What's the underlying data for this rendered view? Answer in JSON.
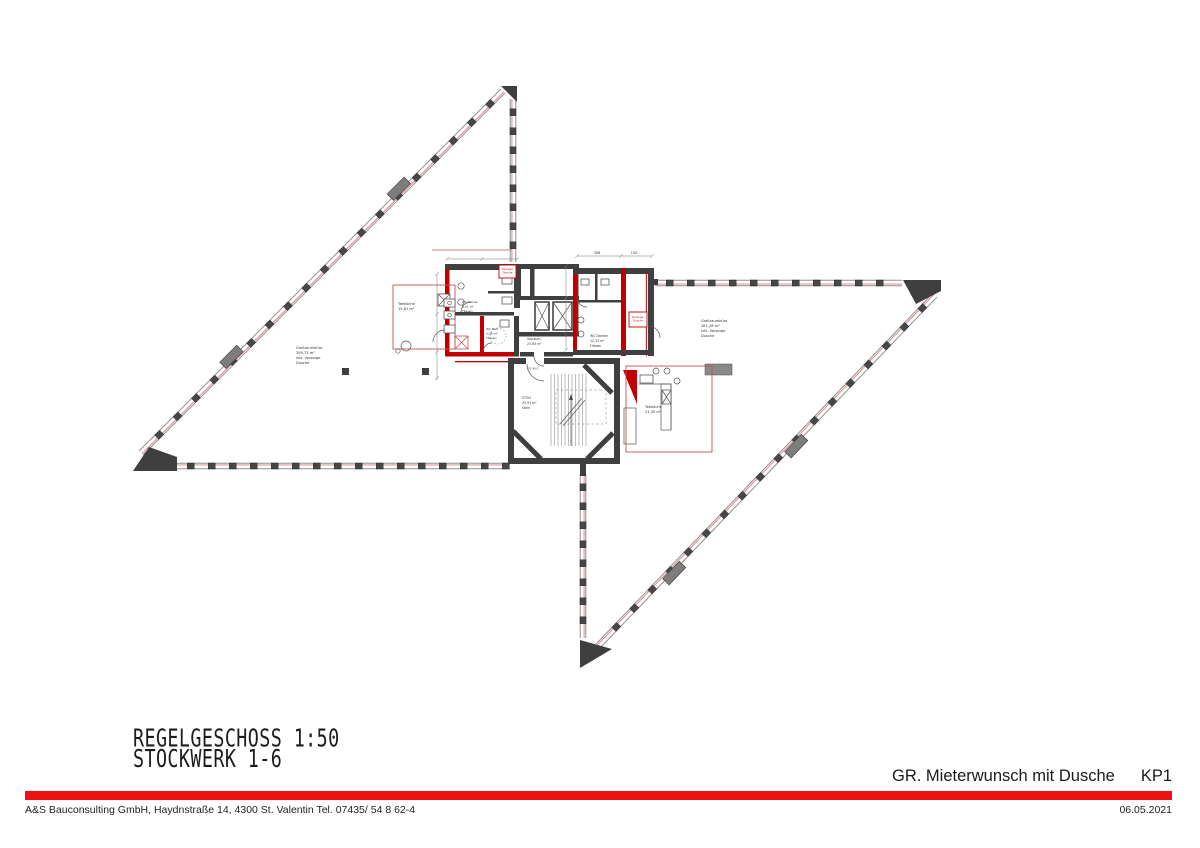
{
  "colors": {
    "accent_red": "#ee1111",
    "marking_red": "#c00000",
    "facade_line_red": "#d08080",
    "wall_gray": "#3f3f3f"
  },
  "titles": {
    "drawing_line1": "REGELGESCHOSS 1:50",
    "drawing_line2": "STOCKWERK 1-6",
    "variant_name": "GR. Mieterwunsch mit Dusche",
    "variant_code": "KP1"
  },
  "footer": {
    "company": "A&S Bauconsulting GmbH, Haydnstraße 14, 4300 St. Valentin Tel. 07435/ 54 8 62-4",
    "date": "06.05.2021"
  },
  "plan": {
    "rooms": {
      "office_left": {
        "name": "Großraumbüro",
        "area": "290,73 m²",
        "note1": "inkl. Vorsorge",
        "note2": "Dusche"
      },
      "office_right": {
        "name": "Großraumbüro",
        "area": "281,26 m²",
        "note1": "inkl. Vorsorge",
        "note2": "Dusche"
      },
      "tea_left": {
        "name": "Teeküche",
        "area": "15,81 m²"
      },
      "tea_right": {
        "name": "Teeküche",
        "area": "21,35 m²"
      },
      "wc_men": {
        "name": "WC Herren",
        "area": "9,61 m²",
        "finish": "Fliesen"
      },
      "wc_acc": {
        "name": "WC Beh.",
        "area": "3,98 m²",
        "finish": "Fliesen"
      },
      "wc_women": {
        "name": "WC Damen",
        "area": "12,33 m²",
        "finish": "Fliesen"
      },
      "lobby": {
        "name": "Vorraum",
        "area": "23,63 m²"
      },
      "stair": {
        "name": "STGH",
        "area": "33,91 m²",
        "finish": "Stein"
      }
    },
    "annotations": {
      "shower1_line1": "Vorsorge",
      "shower1_line2": "Dusche",
      "shower2_line1": "Vorsorge",
      "shower2_line2": "Dusche",
      "door_rating": "EI2 90-C"
    },
    "dimensions": {
      "d1": "306",
      "d2": "150"
    }
  }
}
